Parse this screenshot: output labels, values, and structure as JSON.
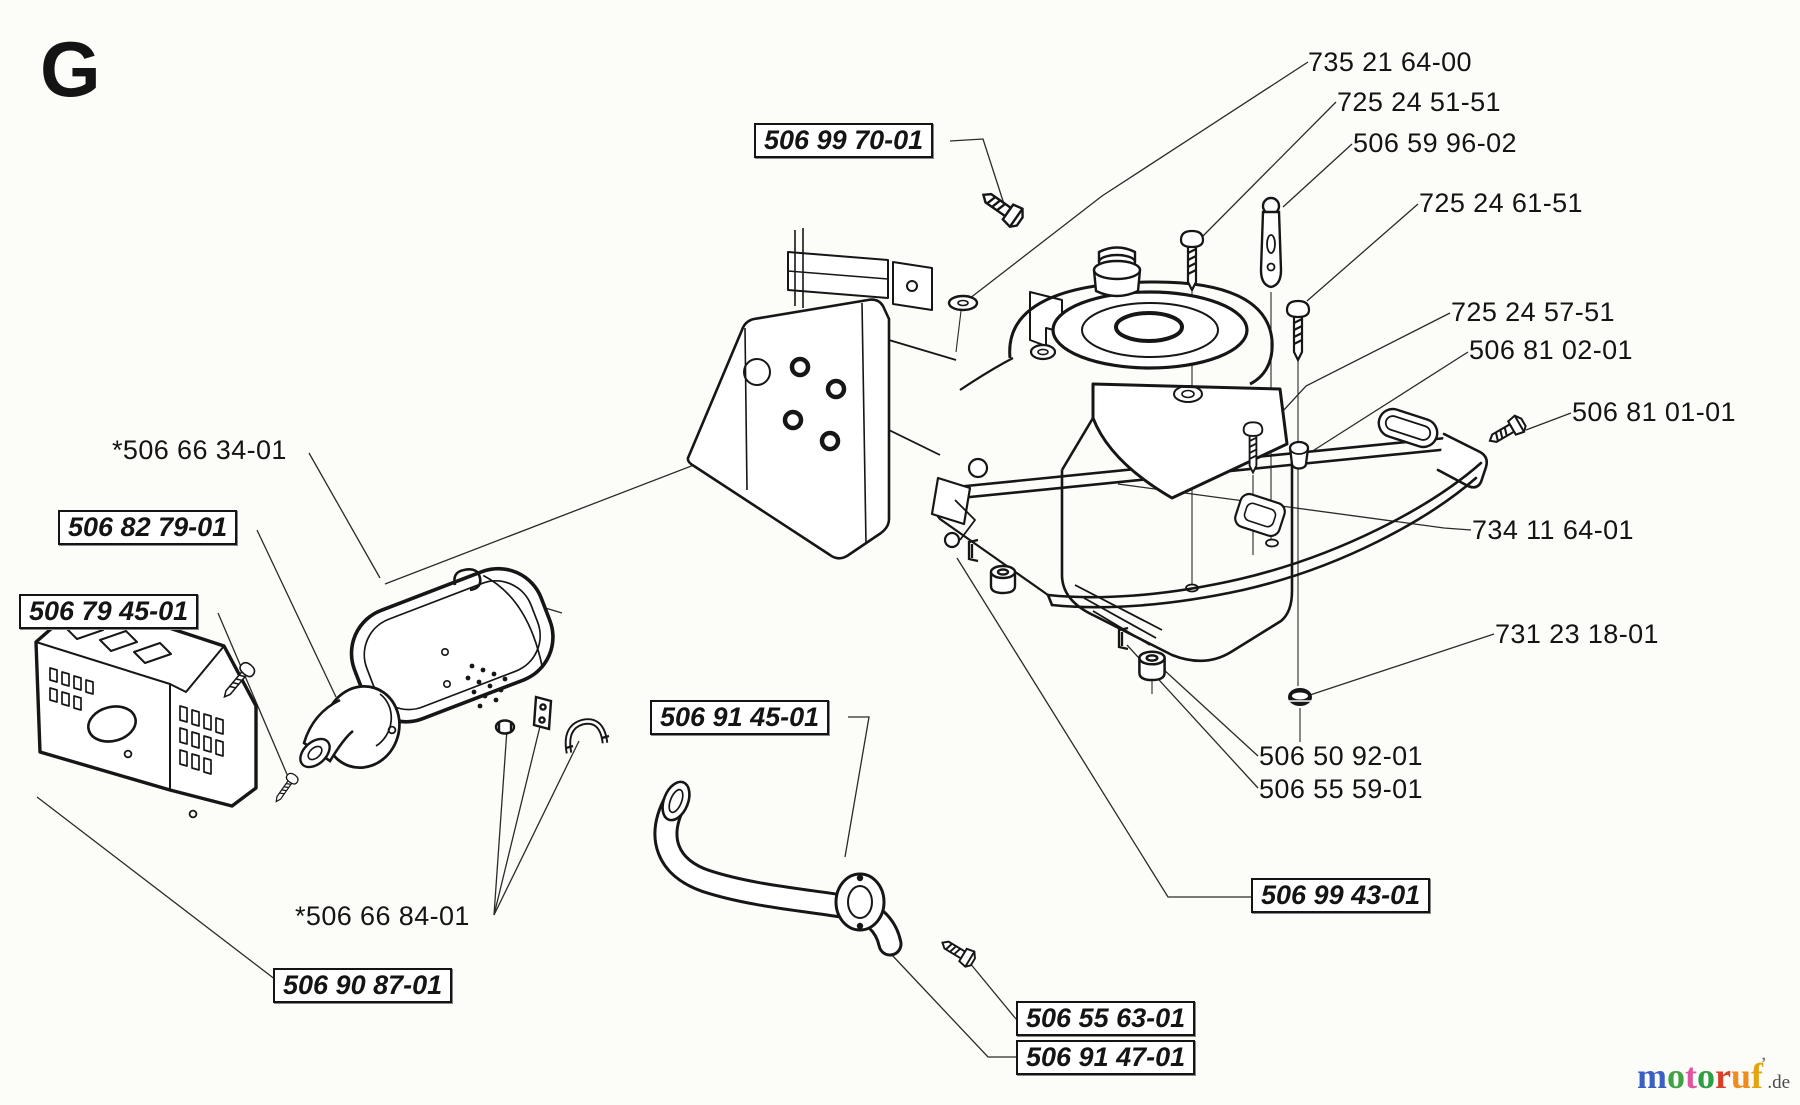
{
  "page": {
    "section_letter": "G",
    "background_color": "#fcfcf9",
    "line_color": "#161616"
  },
  "part_labels": {
    "plain": [
      {
        "id": "735-21-64-00",
        "text": "735 21 64-00"
      },
      {
        "id": "725-24-51-51",
        "text": "725 24 51-51"
      },
      {
        "id": "506-59-96-02",
        "text": "506 59 96-02"
      },
      {
        "id": "725-24-61-51",
        "text": "725 24 61-51"
      },
      {
        "id": "725-24-57-51",
        "text": "725 24 57-51"
      },
      {
        "id": "506-81-02-01",
        "text": "506 81 02-01"
      },
      {
        "id": "506-81-01-01",
        "text": "506 81 01-01"
      },
      {
        "id": "734-11-64-01",
        "text": "734 11 64-01"
      },
      {
        "id": "731-23-18-01",
        "text": "731 23 18-01"
      },
      {
        "id": "506-50-92-01",
        "text": "506 50 92-01"
      },
      {
        "id": "506-55-59-01",
        "text": "506 55 59-01"
      },
      {
        "id": "506-66-34-01",
        "text": "*506 66 34-01"
      },
      {
        "id": "506-66-84-01",
        "text": "*506 66 84-01"
      }
    ],
    "boxed": [
      {
        "id": "506-99-70-01",
        "text": "506 99 70-01"
      },
      {
        "id": "506-82-79-01",
        "text": "506 82 79-01"
      },
      {
        "id": "506-79-45-01",
        "text": "506 79 45-01"
      },
      {
        "id": "506-90-87-01",
        "text": "506 90 87-01"
      },
      {
        "id": "506-91-45-01",
        "text": "506 91 45-01"
      },
      {
        "id": "506-55-63-01",
        "text": "506 55 63-01"
      },
      {
        "id": "506-91-47-01",
        "text": "506 91 47-01"
      },
      {
        "id": "506-99-43-01",
        "text": "506 99 43-01"
      }
    ]
  },
  "logo": {
    "letters": [
      {
        "char": "m",
        "color": "#3b5fc4"
      },
      {
        "char": "o",
        "color": "#3fa345"
      },
      {
        "char": "t",
        "color": "#e0559f"
      },
      {
        "char": "o",
        "color": "#2f9e44"
      },
      {
        "char": "r",
        "color": "#d8402a"
      },
      {
        "char": "u",
        "color": "#f08c1e"
      },
      {
        "char": "f",
        "color": "#e3a40e"
      }
    ],
    "tick": "’",
    "suffix": ".de"
  }
}
